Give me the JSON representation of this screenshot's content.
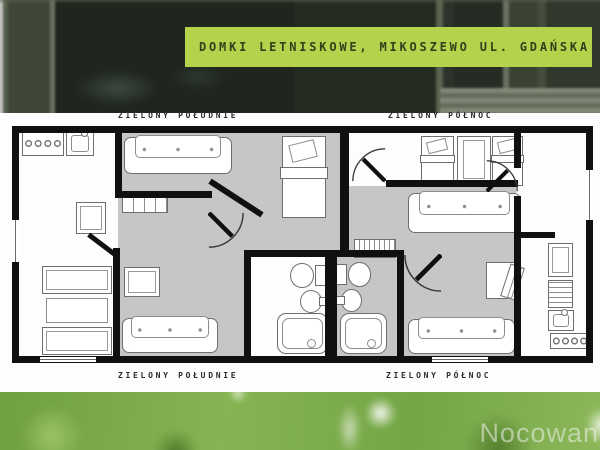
{
  "banner": {
    "title": "DOMKI LETNISKOWE, MIKOSZEWO UL. GDAŃSKA",
    "bg": "#b5d24c",
    "fg": "#2e431c"
  },
  "labels": {
    "top_left": "ZIELONY POŁUDNIE",
    "top_right": "ZIELONY PÓŁNOC",
    "bottom_left": "ZIELONY POŁUDNIE",
    "bottom_right": "ZIELONY PÓŁNOC"
  },
  "watermark": {
    "text": "Nocowani",
    "color": "rgba(238,243,234,0.55)"
  },
  "plan": {
    "wall_color": "#101010",
    "room_gray": "#c6c6c6",
    "rooms": [
      {
        "name": "bedroom-south",
        "x": 118,
        "y": 131,
        "w": 226,
        "h": 121
      },
      {
        "name": "hall-south",
        "x": 118,
        "y": 250,
        "w": 128,
        "h": 108
      },
      {
        "name": "living-north",
        "x": 349,
        "y": 186,
        "w": 167,
        "h": 172
      },
      {
        "name": "bathroom-north",
        "x": 330,
        "y": 254,
        "w": 70,
        "h": 104
      }
    ],
    "furniture": [
      {
        "t": "stove",
        "x": 22,
        "y": 131,
        "w": 42,
        "h": 25
      },
      {
        "t": "sink",
        "x": 66,
        "y": 131,
        "w": 28,
        "h": 25
      },
      {
        "t": "cabinet",
        "x": 76,
        "y": 202,
        "w": 30,
        "h": 32
      },
      {
        "t": "sofa",
        "x": 124,
        "y": 137,
        "w": 108,
        "h": 37
      },
      {
        "t": "bed-v",
        "x": 282,
        "y": 136,
        "w": 44,
        "h": 82
      },
      {
        "t": "shelf",
        "x": 122,
        "y": 197,
        "w": 46,
        "h": 16
      },
      {
        "t": "cabinet",
        "x": 124,
        "y": 267,
        "w": 36,
        "h": 30
      },
      {
        "t": "sofa",
        "x": 122,
        "y": 318,
        "w": 96,
        "h": 35
      },
      {
        "t": "bed-h",
        "x": 42,
        "y": 266,
        "w": 70,
        "h": 28
      },
      {
        "t": "table",
        "x": 46,
        "y": 298,
        "w": 62,
        "h": 25
      },
      {
        "t": "bed-h",
        "x": 42,
        "y": 327,
        "w": 70,
        "h": 28
      },
      {
        "t": "toilet",
        "x": 288,
        "y": 262,
        "w": 38,
        "h": 25,
        "dir": "right"
      },
      {
        "t": "bathsink",
        "x": 300,
        "y": 290,
        "w": 28,
        "h": 21,
        "dir": "right"
      },
      {
        "t": "bathtub",
        "x": 277,
        "y": 313,
        "w": 51,
        "h": 41
      },
      {
        "t": "bed-v",
        "x": 421,
        "y": 136,
        "w": 33,
        "h": 50
      },
      {
        "t": "wardrobe",
        "x": 457,
        "y": 136,
        "w": 34,
        "h": 47
      },
      {
        "t": "bed-v",
        "x": 492,
        "y": 136,
        "w": 31,
        "h": 50
      },
      {
        "t": "sofa",
        "x": 408,
        "y": 193,
        "w": 113,
        "h": 40
      },
      {
        "t": "radiator",
        "x": 354,
        "y": 239,
        "w": 42,
        "h": 19
      },
      {
        "t": "desk",
        "x": 486,
        "y": 262,
        "w": 30,
        "h": 37
      },
      {
        "t": "sofa",
        "x": 408,
        "y": 319,
        "w": 107,
        "h": 35
      },
      {
        "t": "toilet",
        "x": 336,
        "y": 262,
        "w": 37,
        "h": 24,
        "dir": "left"
      },
      {
        "t": "bathsink",
        "x": 336,
        "y": 289,
        "w": 26,
        "h": 21,
        "dir": "left"
      },
      {
        "t": "bathtub",
        "x": 340,
        "y": 313,
        "w": 47,
        "h": 41
      },
      {
        "t": "cabinet",
        "x": 548,
        "y": 243,
        "w": 25,
        "h": 34
      },
      {
        "t": "drawers",
        "x": 548,
        "y": 280,
        "w": 25,
        "h": 28
      },
      {
        "t": "sink",
        "x": 548,
        "y": 310,
        "w": 26,
        "h": 21
      },
      {
        "t": "stove",
        "x": 550,
        "y": 333,
        "w": 40,
        "h": 16
      }
    ],
    "walls": [
      {
        "x": 12,
        "y": 126,
        "w": 338,
        "h": 7
      },
      {
        "x": 346,
        "y": 126,
        "w": 246,
        "h": 7
      },
      {
        "x": 12,
        "y": 126,
        "w": 7,
        "h": 94
      },
      {
        "x": 12,
        "y": 262,
        "w": 7,
        "h": 101
      },
      {
        "x": 12,
        "y": 356,
        "w": 580,
        "h": 7
      },
      {
        "x": 586,
        "y": 126,
        "w": 7,
        "h": 237
      },
      {
        "x": 115,
        "y": 126,
        "w": 7,
        "h": 72
      },
      {
        "x": 115,
        "y": 191,
        "w": 97,
        "h": 7
      },
      {
        "x": 205,
        "y": 195,
        "w": 62,
        "h": 6,
        "r": 33
      },
      {
        "x": 113,
        "y": 248,
        "w": 7,
        "h": 112
      },
      {
        "x": 85,
        "y": 243,
        "w": 36,
        "h": 5,
        "r": 37
      },
      {
        "x": 244,
        "y": 250,
        "w": 7,
        "h": 110
      },
      {
        "x": 244,
        "y": 250,
        "w": 92,
        "h": 7
      },
      {
        "x": 325,
        "y": 250,
        "w": 12,
        "h": 110
      },
      {
        "x": 340,
        "y": 126,
        "w": 9,
        "h": 131
      },
      {
        "x": 330,
        "y": 250,
        "w": 74,
        "h": 7
      },
      {
        "x": 397,
        "y": 250,
        "w": 7,
        "h": 110
      },
      {
        "x": 386,
        "y": 180,
        "w": 132,
        "h": 7
      },
      {
        "x": 514,
        "y": 126,
        "w": 7,
        "h": 42
      },
      {
        "x": 514,
        "y": 196,
        "w": 7,
        "h": 164
      },
      {
        "x": 521,
        "y": 232,
        "w": 34,
        "h": 6
      }
    ],
    "windows": [
      {
        "x": 12,
        "y": 220,
        "w": 7,
        "h": 42,
        "kind": "v"
      },
      {
        "x": 586,
        "y": 170,
        "w": 7,
        "h": 50,
        "kind": "v"
      },
      {
        "x": 40,
        "y": 357,
        "w": 56,
        "h": 5,
        "kind": "h"
      },
      {
        "x": 432,
        "y": 357,
        "w": 56,
        "h": 5,
        "kind": "h"
      }
    ],
    "doors": [
      {
        "x": 208,
        "y": 212,
        "s": 36,
        "r": 0
      },
      {
        "x": 352,
        "y": 148,
        "s": 34,
        "r": 180
      },
      {
        "x": 404,
        "y": 254,
        "s": 38,
        "r": 90
      },
      {
        "x": 486,
        "y": 160,
        "s": 32,
        "r": 270
      }
    ]
  }
}
